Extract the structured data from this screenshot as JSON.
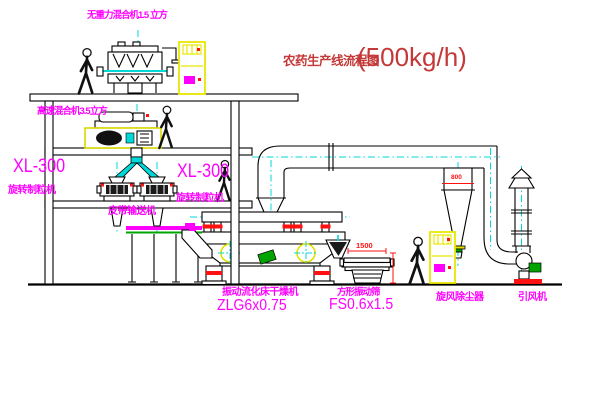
{
  "title": {
    "text_cn": "农药生产线流程图",
    "capacity": "(500kg/h)"
  },
  "labels": {
    "gravityless_mixer": "无重力混合机1.5 立方",
    "high_speed_mixer": "高速混合机3.5立方",
    "granulator_left_model": "XL-300",
    "granulator_left_name": "旋转制粒机",
    "granulator_center_model": "XL-300",
    "granulator_center_name": "旋转制粒机",
    "belt_conveyor": "皮带输送机",
    "fluid_bed_dryer_name": "振动流化床干燥机",
    "fluid_bed_dryer_model": "ZLG6x0.75",
    "square_sieve_name": "方形振动筛",
    "square_sieve_model": "FS0.6x1.5",
    "cyclone_dust_collector": "旋风除尘器",
    "induced_draft_fan": "引风机"
  },
  "dimension_labels": {
    "sieve_length": "1500",
    "cyclone_marking": "800"
  },
  "colors": {
    "label_magenta": "#ff00ff",
    "title_red": "#c43838",
    "dimension_red": "#ff1111",
    "centerline_cyan": "#00d8d8",
    "cabinet_yellow": "#e8e800",
    "motor_green": "#00a400",
    "line_black": "#000000",
    "background": "#ffffff"
  }
}
